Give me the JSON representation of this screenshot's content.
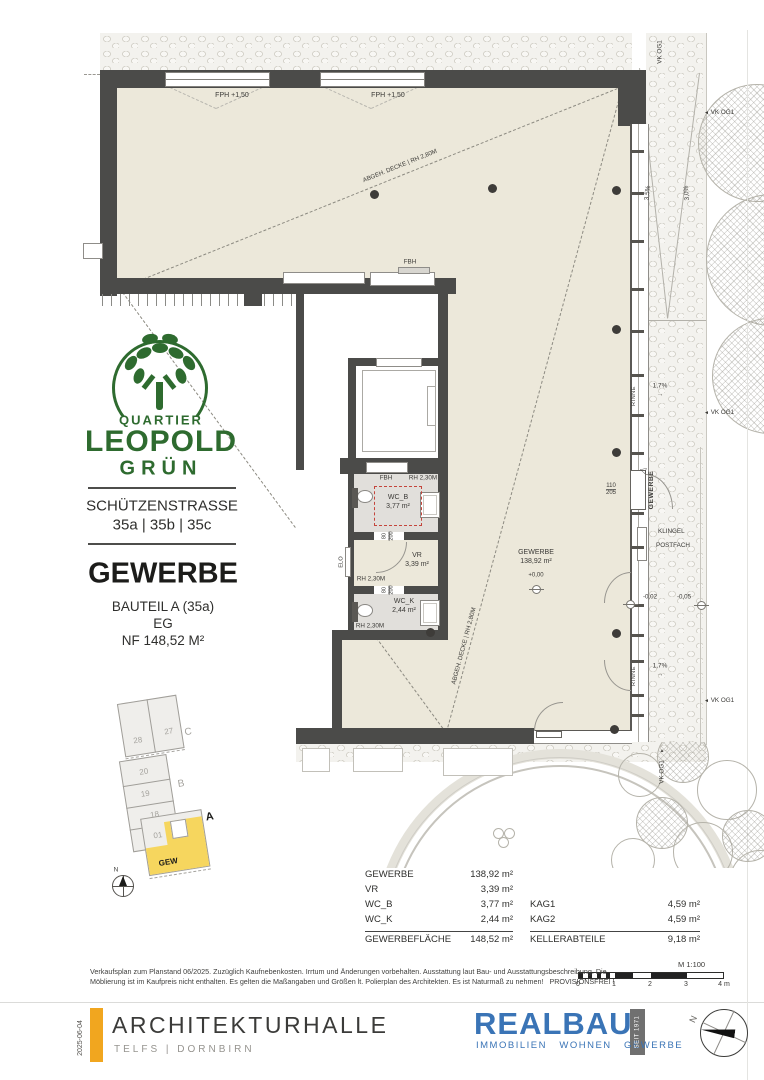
{
  "plan": {
    "fph": "FPH +1,50",
    "ceiling": "ABGEH. DECKE | RH 2,80M",
    "fbh": "FBH",
    "rh230": "RH 2,30M",
    "door_w": "80",
    "door_h": "200",
    "wcb": "WC_B",
    "wcb_area": "3,77 m²",
    "vr": "VR",
    "vr_area": "3,39 m²",
    "wck": "WC_K",
    "wck_area": "2,44 m²",
    "elo": "ELO",
    "gewerbe": "GEWERBE",
    "gewerbe_area": "138,92 m²",
    "lvl0": "+0,00",
    "lvlm2": "-0,02",
    "lvlm5": "-0,05",
    "entry_w": "110",
    "entry_h": "205",
    "entry_label": "GEWERBE",
    "klingel": "KLINGEL",
    "postfach": "POSTFACH",
    "vk": "VK OG1",
    "s35": "3,5%",
    "s30": "3,0%",
    "s17": "1,7%",
    "rinne": "RINNE"
  },
  "icons": {
    "arrow_left": "◄",
    "arrow_up": "▲",
    "arrow_right": "→",
    "door_tri": "◁"
  },
  "branding": {
    "quartier": "QUARTIER",
    "leopold": "LEOPOLD",
    "gruen": "GRÜN"
  },
  "address": {
    "street": "SCHÜTZENSTRASSE",
    "numbers": "35a | 35b | 35c"
  },
  "unit": {
    "title": "GEWERBE",
    "part": "BAUTEIL A (35a)",
    "floor": "EG",
    "nf": "NF 148,52 M²"
  },
  "siteplan": {
    "u28": "28",
    "u27": "27",
    "u20": "20",
    "u19": "19",
    "u18": "18",
    "u01": "01",
    "bC": "C",
    "bB": "B",
    "bA": "A",
    "gew": "GEW",
    "north": "N"
  },
  "table": {
    "rows_left": [
      {
        "label": "GEWERBE",
        "value": "138,92 m²"
      },
      {
        "label": "VR",
        "value": "3,39 m²"
      },
      {
        "label": "WC_B",
        "value": "3,77 m²"
      },
      {
        "label": "WC_K",
        "value": "2,44 m²"
      }
    ],
    "total_left": {
      "label": "GEWERBEFLÄCHE",
      "value": "148,52 m²"
    },
    "rows_right": [
      {
        "label": "KAG1",
        "value": "4,59 m²"
      },
      {
        "label": "KAG2",
        "value": "4,59 m²"
      }
    ],
    "total_right": {
      "label": "KELLERABTEILE",
      "value": "9,18 m²"
    }
  },
  "scale": {
    "label": "M 1:100",
    "t0": "0",
    "t1": "1",
    "t2": "2",
    "t3": "3",
    "t4": "4 m"
  },
  "disclaimer": {
    "line1": "Verkaufsplan zum Planstand 06/2025. Zuzüglich Kaufnebenkosten. Irrtum und Änderungen vorbehalten. Ausstattung laut Bau- und Ausstattungsbeschreibung. Die",
    "line2": "Möblierung ist im Kaufpreis nicht enthalten. Es gelten die Maßangaben und Größen lt. Polierplan des Architekten. Es ist Naturmaß zu nehmen!   PROVISIONSFREI !"
  },
  "footer": {
    "date": "2025-06-04",
    "studio": "ARCHITEKTURHALLE",
    "studio_sub": "TELFS | DORNBIRN",
    "brand": "REALBAU",
    "brand_sub": "IMMOBILIEN   WOHNEN   GEWERBE",
    "seit": "SEIT 1971",
    "north": "N"
  }
}
